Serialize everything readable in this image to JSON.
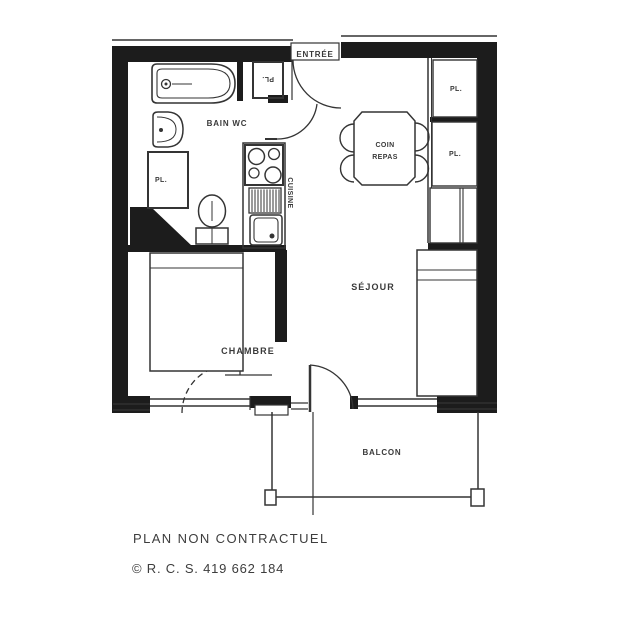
{
  "plan": {
    "rooms": {
      "entree": "ENTRÉE",
      "bain_wc": "BAIN WC",
      "cuisine": "CUISINE",
      "coin_repas_line1": "COIN",
      "coin_repas_line2": "REPAS",
      "sejour": "SÉJOUR",
      "chambre": "CHAMBRE",
      "balcon": "BALCON",
      "closet_hall": "PL.",
      "closet_bath": "PL.",
      "closet_right_top": "PL.",
      "closet_right_mid": "PL."
    },
    "colors": {
      "wall": "#1c1c1c",
      "line": "#343434",
      "paper": "#ffffff"
    }
  },
  "footer": {
    "disclaimer": "PLAN NON CONTRACTUEL",
    "registration": "© R. C. S. 419 662 184"
  }
}
